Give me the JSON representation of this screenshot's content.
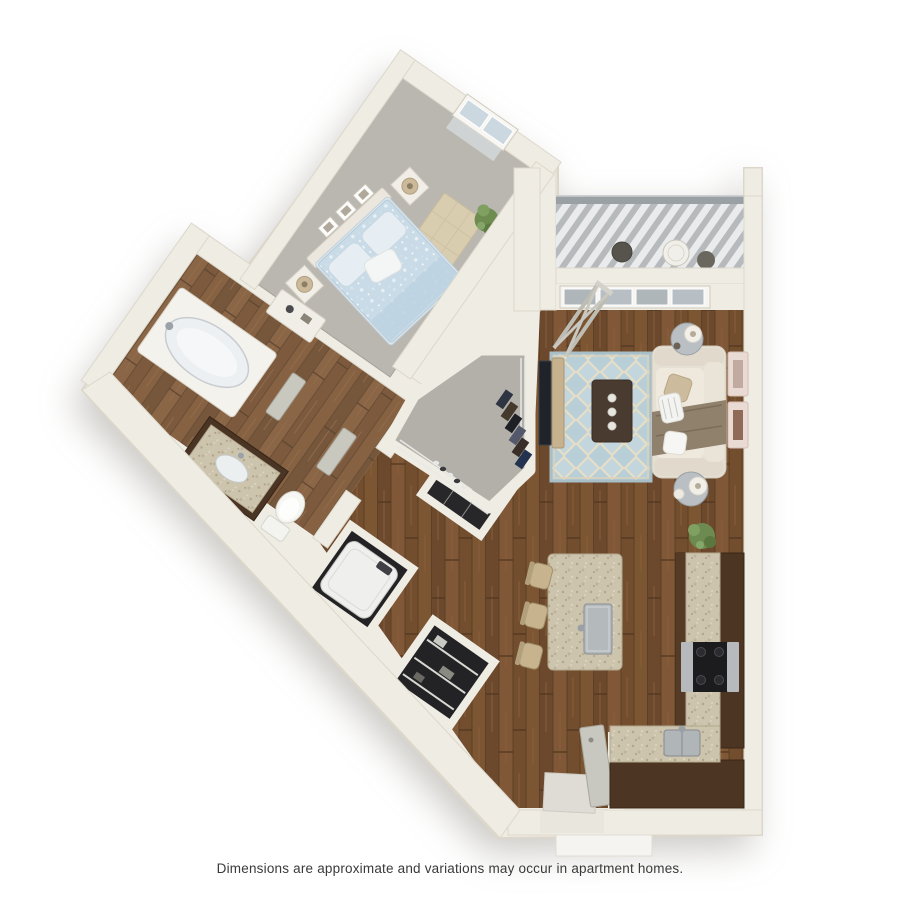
{
  "caption": {
    "text": "Dimensions are approximate and variations may occur in apartment homes."
  },
  "floor_plan": {
    "kind": "3d-rendered-floor-plan",
    "layout": "one-bedroom-apartment",
    "rooms": [
      {
        "name": "bedroom",
        "flooring": "carpet",
        "items": [
          "bed-with-blue-bedding",
          "headboard",
          "two-nightstands",
          "two-table-lamps",
          "three-wall-frames",
          "area-rug",
          "dresser",
          "potted-plant",
          "window"
        ]
      },
      {
        "name": "bathroom",
        "flooring": "hardwood",
        "items": [
          "bathtub",
          "vanity-with-sink",
          "toilet"
        ]
      },
      {
        "name": "walk-in-closet",
        "flooring": "carpet",
        "items": [
          "hanging-clothes",
          "wire-shelving",
          "shoe-row"
        ]
      },
      {
        "name": "laundry-closet",
        "items": [
          "washer"
        ]
      },
      {
        "name": "storage-closet",
        "items": [
          "wire-shelves"
        ]
      },
      {
        "name": "hallway",
        "flooring": "hardwood",
        "items": [
          "bedroom-door",
          "bathroom-door"
        ]
      },
      {
        "name": "living-room",
        "flooring": "hardwood",
        "items": [
          "sofa",
          "throw-blanket",
          "pillows",
          "coffee-table",
          "trellis-area-rug",
          "tv",
          "tv-stand",
          "two-side-tables",
          "two-lamps",
          "two-wall-frames",
          "potted-plant",
          "x-frame-console"
        ]
      },
      {
        "name": "kitchen",
        "flooring": "hardwood",
        "items": [
          "island-with-sink",
          "three-bar-stools",
          "l-shaped-counter",
          "range-cooktop",
          "corner-sink",
          "entry-door",
          "entry-tile"
        ]
      },
      {
        "name": "balcony",
        "flooring": "slatted-deck",
        "items": [
          "railing",
          "bistro-table",
          "two-chairs",
          "sliding-glass-door"
        ]
      }
    ],
    "colors": {
      "wall": "#efece4",
      "hardwood": "#77512f",
      "carpet": "#bab7b1",
      "granite_counter": "#cdc4ae",
      "cabinet_brown": "#4c3522",
      "rug_blue": "#b8cfd8",
      "bedding_blue": "#c8dbe7",
      "sofa_cream": "#e6e0d4",
      "deck_gray": "#b6babd",
      "caption_text": "#3a3a3a",
      "background": "#ffffff"
    }
  }
}
